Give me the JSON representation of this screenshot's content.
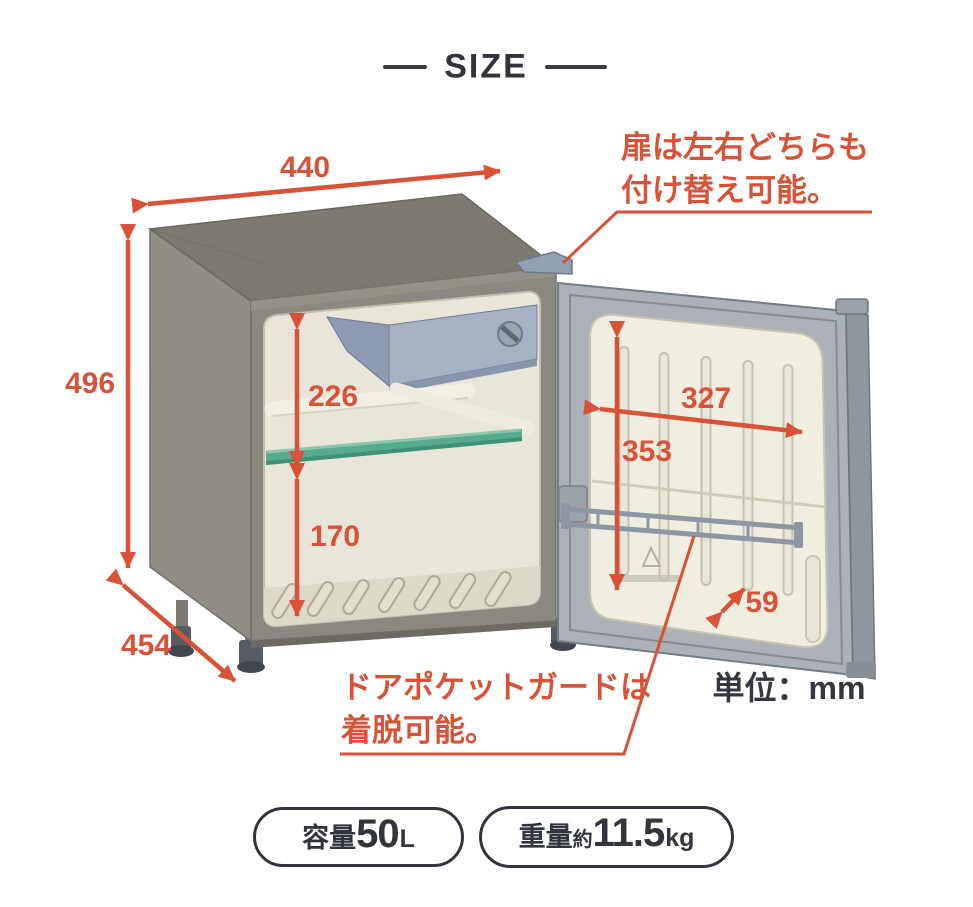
{
  "figure": {
    "title": "SIZE",
    "unit_label": "単位：mm"
  },
  "dimensions": {
    "width_mm": "440",
    "height_mm": "496",
    "depth_mm": "454",
    "upper_compartment_mm": "226",
    "lower_compartment_mm": "170",
    "door_inner_width_mm": "327",
    "door_inner_height_mm": "353",
    "door_pocket_depth_mm": "59"
  },
  "notes": {
    "door_swap": [
      "扉は左右どちらも",
      "付け替え可能。"
    ],
    "door_pocket": [
      "ドアポケットガードは",
      "着脱可能。"
    ]
  },
  "badges": {
    "capacity": {
      "label": "容量",
      "value": "50",
      "unit": "L"
    },
    "weight": {
      "label": "重量",
      "approx": "約",
      "value": "11.5",
      "unit": "kg"
    }
  },
  "colors": {
    "accent": "#d85238",
    "ink": "#32353d",
    "body_gray": "#8a8880",
    "interior_cream": "#e9e6d9",
    "shelf_green": "#57aa8c",
    "freezer_blue": "#a6b1c4"
  }
}
